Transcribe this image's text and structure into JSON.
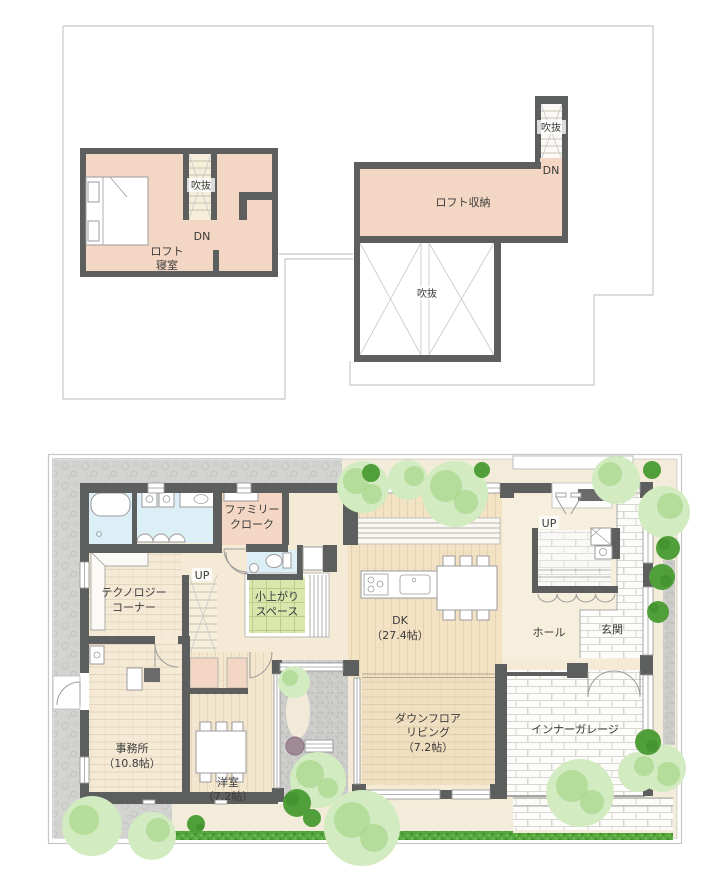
{
  "plan_type": "floor-plan",
  "loft_plan": {
    "bedroom": {
      "name_line1": "ロフト",
      "name_line2": "寝室",
      "stair_void_label": "吹抜",
      "down_label": "DN"
    },
    "storage": {
      "name": "ロフト収納",
      "stair_void_label": "吹抜",
      "down_label": "DN"
    },
    "void": {
      "label": "吹抜"
    }
  },
  "main_plan": {
    "family_cloak": {
      "line1": "ファミリー",
      "line2": "クローク"
    },
    "tech_corner": {
      "line1": "テクノロジー",
      "line2": "コーナー"
    },
    "stairs_center": {
      "label": "UP"
    },
    "koagari": {
      "line1": "小上がり",
      "line2": "スペース"
    },
    "dk": {
      "line1": "DK",
      "line2": "（27.4帖）"
    },
    "hall": {
      "label": "ホール"
    },
    "genkan": {
      "label": "玄関"
    },
    "stairs_hall": {
      "label": "UP"
    },
    "office": {
      "line1": "事務所",
      "line2": "（10.8帖）"
    },
    "western_room": {
      "line1": "洋室",
      "line2": "（7.2帖）"
    },
    "down_floor_living": {
      "line1": "ダウンフロア",
      "line2": "リビング",
      "line3": "（7.2帖）"
    },
    "inner_garage": {
      "label": "インナーガレージ"
    }
  },
  "colors": {
    "wall": "#5d5e5e",
    "loft_room_pink": "#f3d6c3",
    "stair_cream": "#f4eedb",
    "wet_area_blue": "#dceef6",
    "tatami_green": "#d9e6ac",
    "floor_wood": "#f5ead5",
    "dk_wood": "#f3e2c3",
    "hall_wood": "#f7efdd",
    "living_wood": "#f1dfc2",
    "stone_gray": "#d3d3d1",
    "courtyard_stone": "#cbcbc9",
    "path_beige": "#f4ecda",
    "hedge_green": "#57a73f",
    "tree_green": "#d2ebc0",
    "footprint_outline": "#cfcfcf"
  }
}
